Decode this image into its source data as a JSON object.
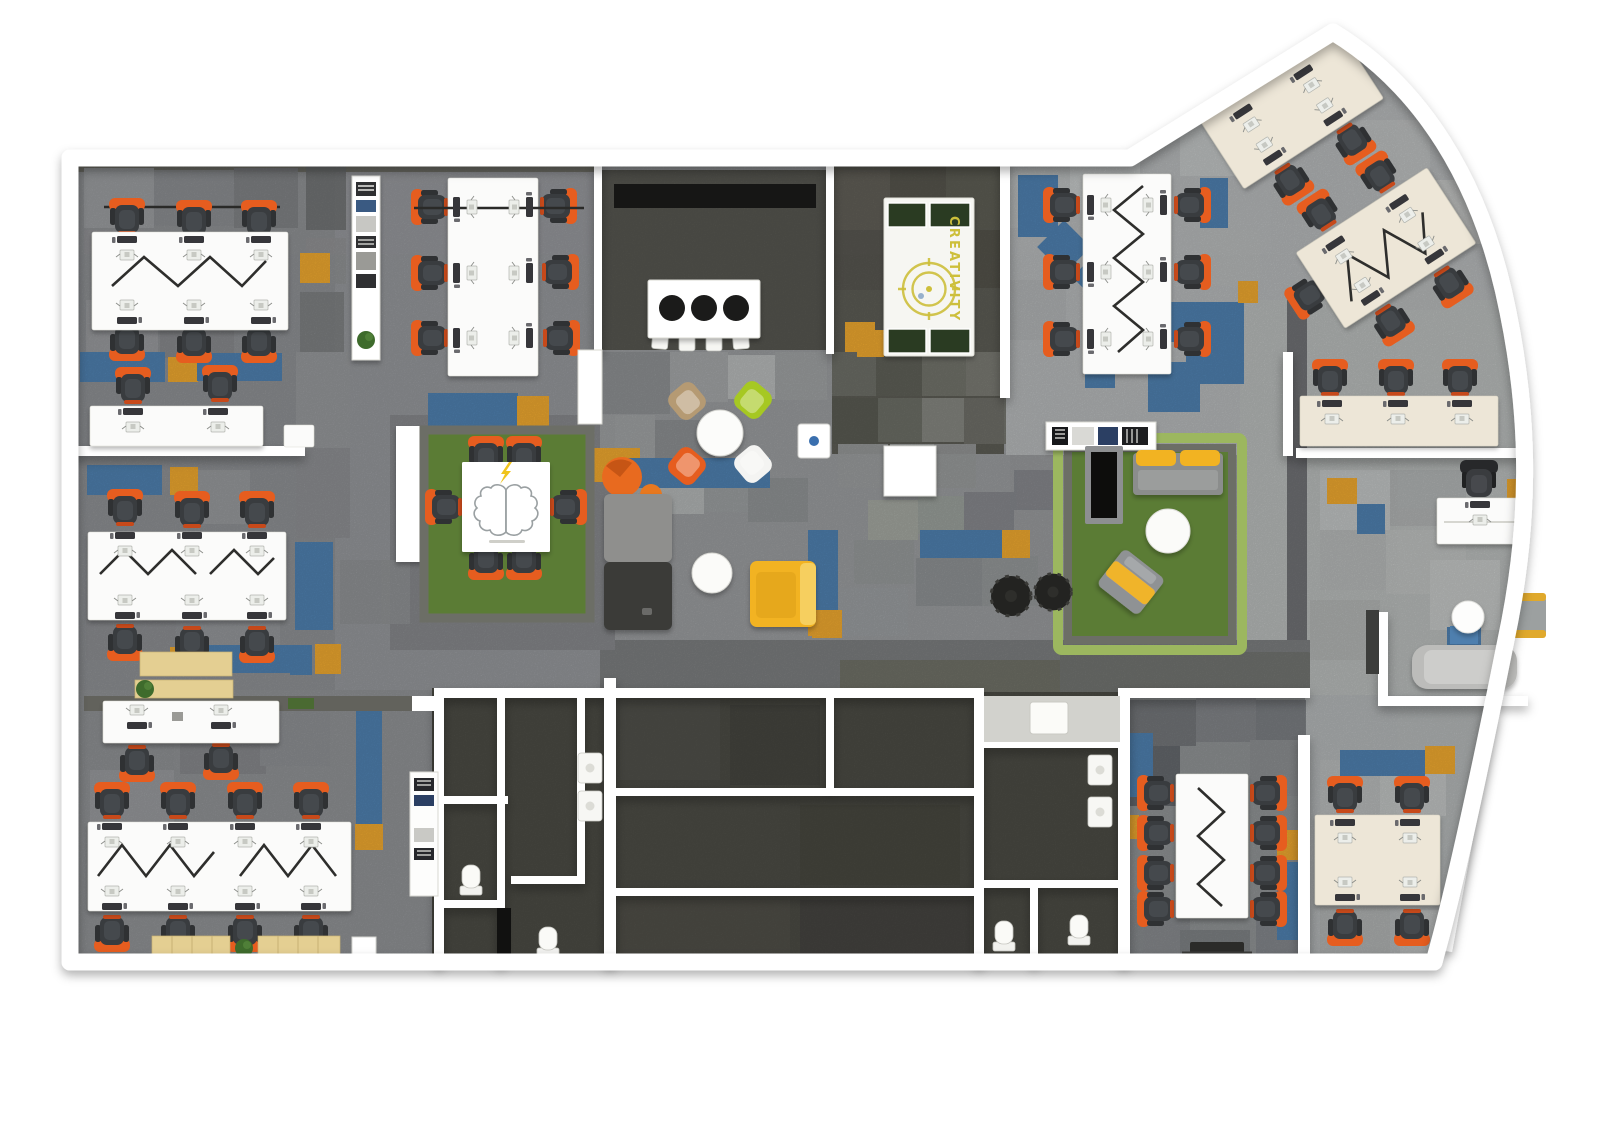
{
  "scene": {
    "type": "office-floorplan-render",
    "view": "top-down-3d",
    "canvas_width": 1600,
    "canvas_height": 1141
  },
  "labels": {
    "creativity_table": "CREATIVITY"
  },
  "icons": {
    "brain_icon": "brain outline with lightning bolt",
    "lightning_icon": "⚡",
    "target_icon": "concentric yellow target circles",
    "plant_icon": "round green plant"
  },
  "colors": {
    "wall": "#ffffff",
    "floor_base": "#97999b",
    "floor_light": "#b6b9ba",
    "room_dark": "#4b4b44",
    "creativity_room": "#5c5c54",
    "dark_band": "#7b7d7e",
    "carpet_blue": "#4e7fae",
    "carpet_orange": "#eca72f",
    "chair_orange": "#e65d1f",
    "chair_seat": "#3b3e41",
    "desk_white": "#fbfbfa",
    "desk_cream": "#ede6d7",
    "rug_green": "#5b7c35",
    "rug_border": "#6c6e66",
    "sofa_gray": "#909090",
    "sofa_dark": "#3a3a37",
    "yellow": "#f2b324",
    "wood": "#e4cf92",
    "pingpong_green": "#2c3a20",
    "creativity": "#cdbf3b",
    "lime": "#a6c822",
    "tan": "#b59a73",
    "white_chair": "#f4f4f2",
    "stool_black": "#1b1b1a",
    "zigzag": "#2e2e2c",
    "plant": "#3e6b2c"
  }
}
